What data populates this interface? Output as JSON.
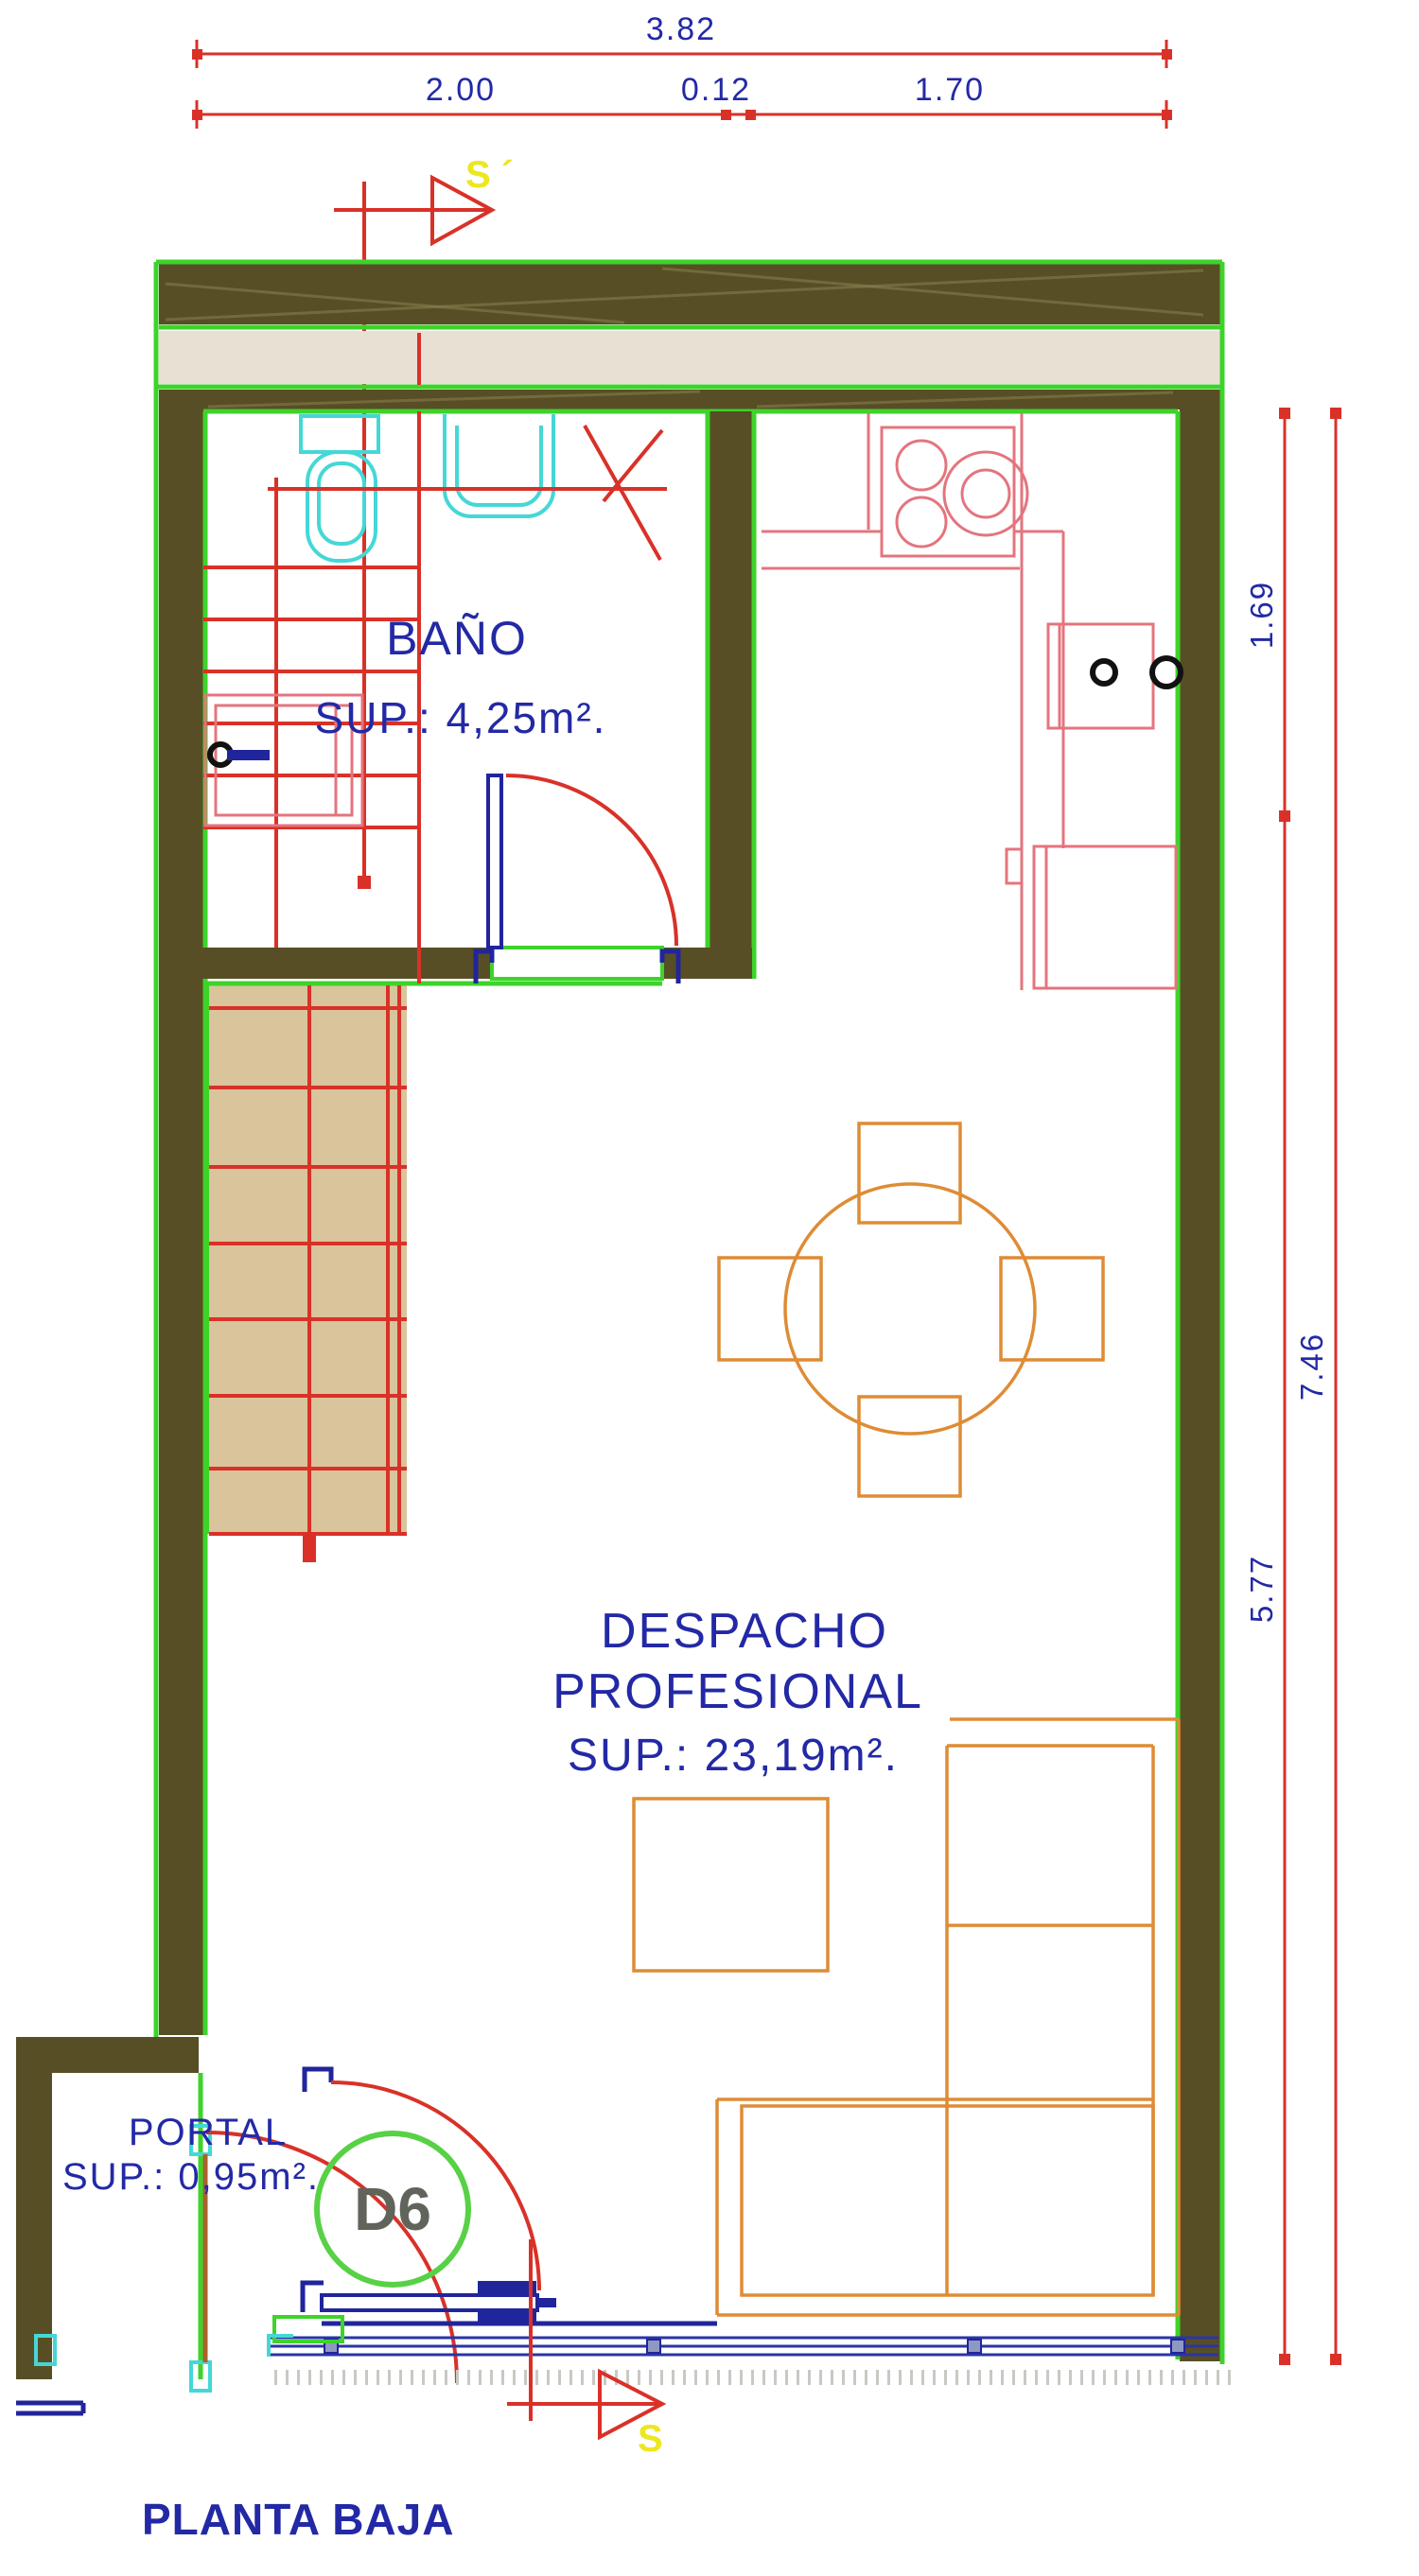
{
  "title": "PLANTA BAJA",
  "section_markers": {
    "top": "S ´",
    "bottom": "S"
  },
  "door_badge": "D6",
  "dimensions": {
    "top": {
      "overall": "3.82",
      "segments": [
        "2.00",
        "0.12",
        "1.70"
      ]
    },
    "right": {
      "upper": "1.69",
      "overall": "7.46",
      "lower": "5.77"
    }
  },
  "rooms": {
    "bathroom": {
      "name": "BAÑO",
      "area": "SUP.:  4,25m²."
    },
    "office": {
      "name": "DESPACHO",
      "name2": "PROFESIONAL",
      "area": "SUP.:  23,19m²."
    },
    "portal": {
      "name": "PORTAL",
      "area": "SUP.:  0,95m²."
    }
  },
  "colors": {
    "wall": "#584e25",
    "green": "#3ed32b",
    "red": "#d93128",
    "salmon": "#e4747e",
    "cyan": "#45d7d7",
    "orange": "#de8c35",
    "bluetext": "#2329a5",
    "doorblue": "#20259c",
    "yellow": "#ece71f",
    "band": "#e8e1d3",
    "stair": "#d9c49c",
    "grayfill": "#a9aeb6",
    "d6fill": "#d3d8cb",
    "d6stroke": "#57d145",
    "d6text": "#60645a",
    "glass": "#2a35a5",
    "hatch": "#8b7f52",
    "black": "#111111",
    "walkhatch": "#c9c9c4"
  }
}
